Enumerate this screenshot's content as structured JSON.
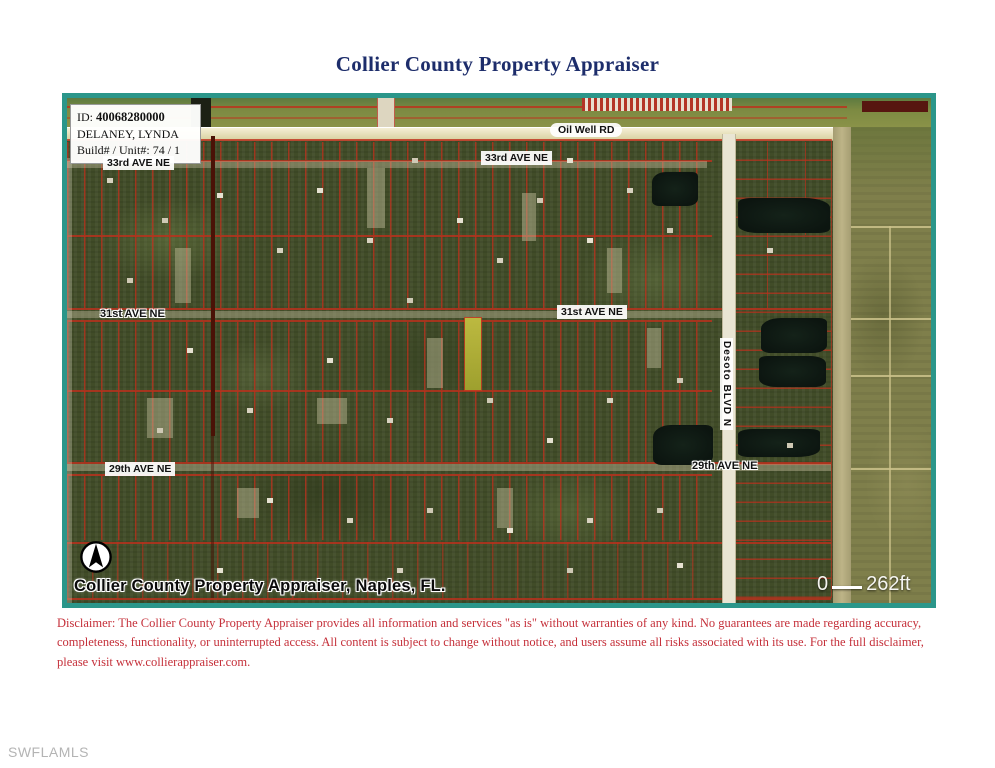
{
  "page": {
    "title": "Collier County Property Appraiser",
    "watermark": "SWFLAMLS"
  },
  "map": {
    "info_box": {
      "id_label": "ID:",
      "id_value": "40068280000",
      "owner": "DELANEY, LYNDA",
      "build_unit_label": "Build# / Unit#:",
      "build_unit_value": "74 / 1"
    },
    "street_labels": {
      "oil_well": "Oil Well RD",
      "ave_33rd_left": "33rd AVE NE",
      "ave_33rd_center": "33rd AVE NE",
      "ave_31st_left": "31st AVE NE",
      "ave_31st_center": "31st AVE NE",
      "ave_29th_left": "29th AVE NE",
      "ave_29th_right": "29th AVE NE",
      "desoto_blvd": "Desoto BLVD N"
    },
    "attribution": "Collier County Property Appraiser, Naples, FL.",
    "scale": {
      "start": "0",
      "distance": "262ft"
    }
  },
  "disclaimer": "Disclaimer: The Collier County Property Appraiser provides all information and services \"as is\" without warranties of any kind. No guarantees are made regarding accuracy, completeness, functionality, or uninterrupted access. All content is subject to change without notice, and users assume all risks associated with its use. For the full disclaimer, please visit www.collierappraiser.com.",
  "colors": {
    "frame_teal": "#2b968a",
    "parcel_line_red": "#be3222",
    "highlight_parcel_yellow": "#b2af35",
    "title_navy": "#1d2d6b",
    "disclaimer_red": "#c5303a",
    "road_tan": "#e3dcb0",
    "pond_dark": "#0e1a14"
  }
}
